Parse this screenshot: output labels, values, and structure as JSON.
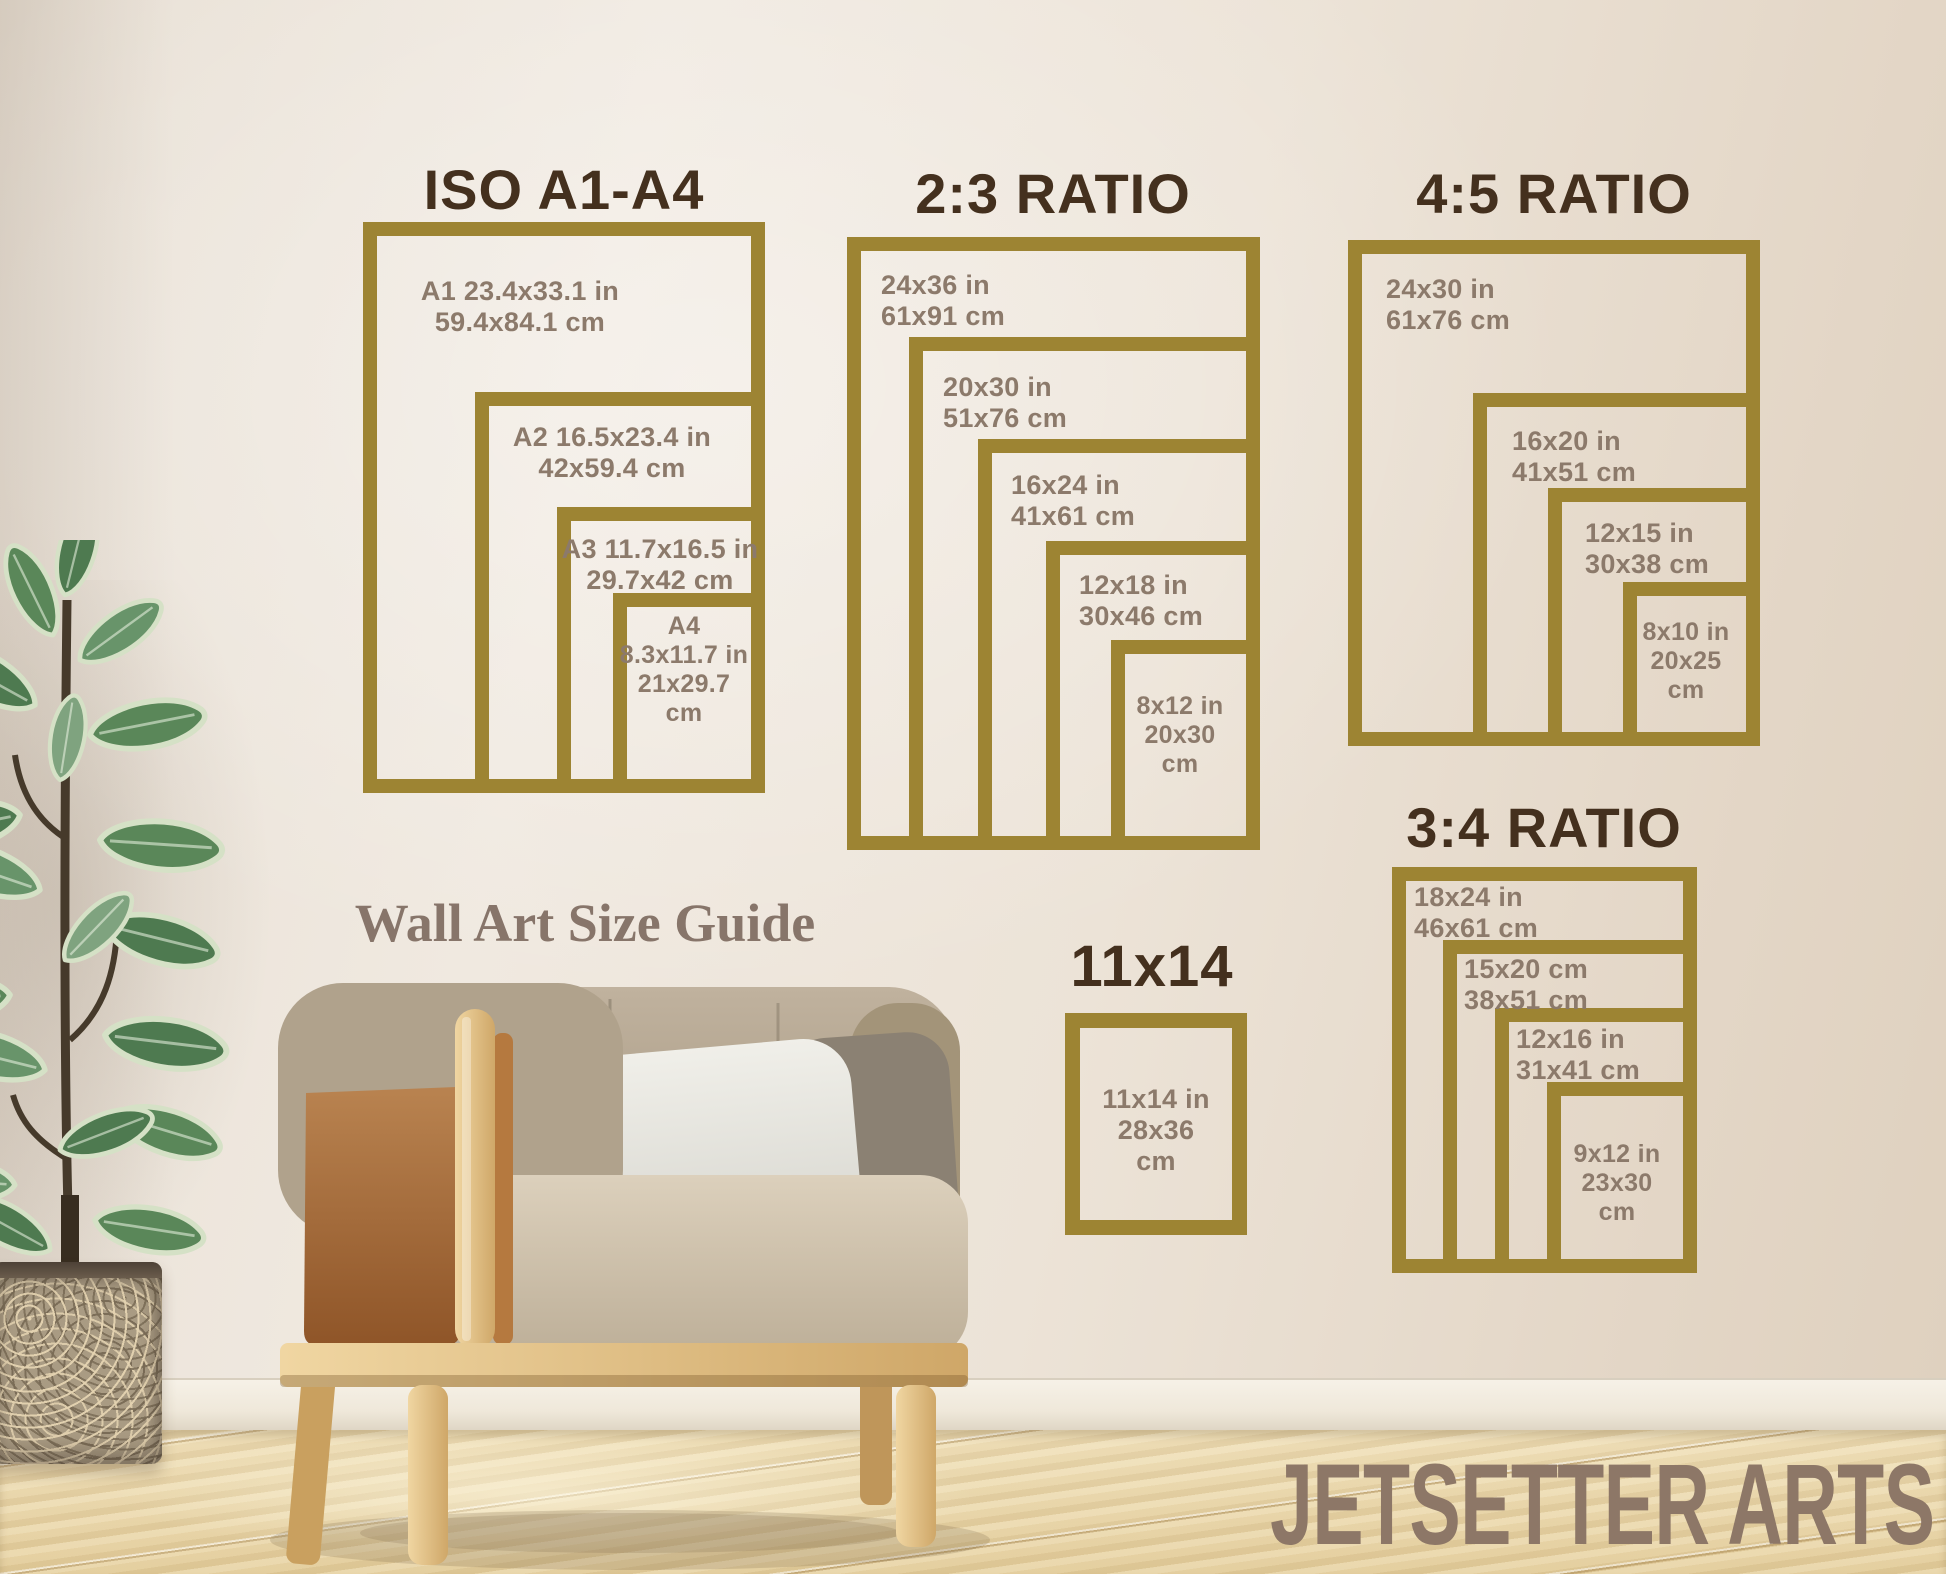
{
  "overlay": {
    "wall_text": "Wall Art Size Guide",
    "brand": "JETSETTER ARTS"
  },
  "colors": {
    "frame_gold": "#9d8433",
    "title_brown": "#44301e",
    "label_taupe": "#8c7a6b",
    "wall_cream": "#ece4d8",
    "floor_wood": "#e9d7ac",
    "leather_tan": "#a96f3e",
    "leaf_green": "#57815a"
  },
  "sections": [
    {
      "title": "ISO A1-A4",
      "sizes": [
        {
          "lines": [
            "A1 23.4x33.1 in",
            "59.4x84.1 cm"
          ]
        },
        {
          "lines": [
            "A2 16.5x23.4 in",
            "42x59.4 cm"
          ]
        },
        {
          "lines": [
            "A3 11.7x16.5 in",
            "29.7x42 cm"
          ]
        },
        {
          "lines": [
            "A4",
            "8.3x11.7 in",
            "21x29.7",
            "cm"
          ]
        }
      ]
    },
    {
      "title": "2:3 RATIO",
      "sizes": [
        {
          "lines": [
            "24x36 in",
            "61x91 cm"
          ]
        },
        {
          "lines": [
            "20x30 in",
            "51x76 cm"
          ]
        },
        {
          "lines": [
            "16x24 in",
            "41x61 cm"
          ]
        },
        {
          "lines": [
            "12x18 in",
            "30x46 cm"
          ]
        },
        {
          "lines": [
            "8x12 in",
            "20x30",
            "cm"
          ]
        }
      ]
    },
    {
      "title": "4:5 RATIO",
      "sizes": [
        {
          "lines": [
            "24x30 in",
            "61x76 cm"
          ]
        },
        {
          "lines": [
            "16x20 in",
            "41x51 cm"
          ]
        },
        {
          "lines": [
            "12x15 in",
            "30x38 cm"
          ]
        },
        {
          "lines": [
            "8x10 in",
            "20x25",
            "cm"
          ]
        }
      ]
    },
    {
      "title": "3:4 RATIO",
      "sizes": [
        {
          "lines": [
            "18x24 in",
            "46x61 cm"
          ]
        },
        {
          "lines": [
            "15x20 cm",
            "38x51 cm"
          ]
        },
        {
          "lines": [
            "12x16 in",
            "31x41 cm"
          ]
        },
        {
          "lines": [
            "9x12 in",
            "23x30",
            "cm"
          ]
        }
      ]
    },
    {
      "title": "11x14",
      "sizes": [
        {
          "lines": [
            "11x14 in",
            "28x36",
            "cm"
          ]
        }
      ]
    }
  ]
}
